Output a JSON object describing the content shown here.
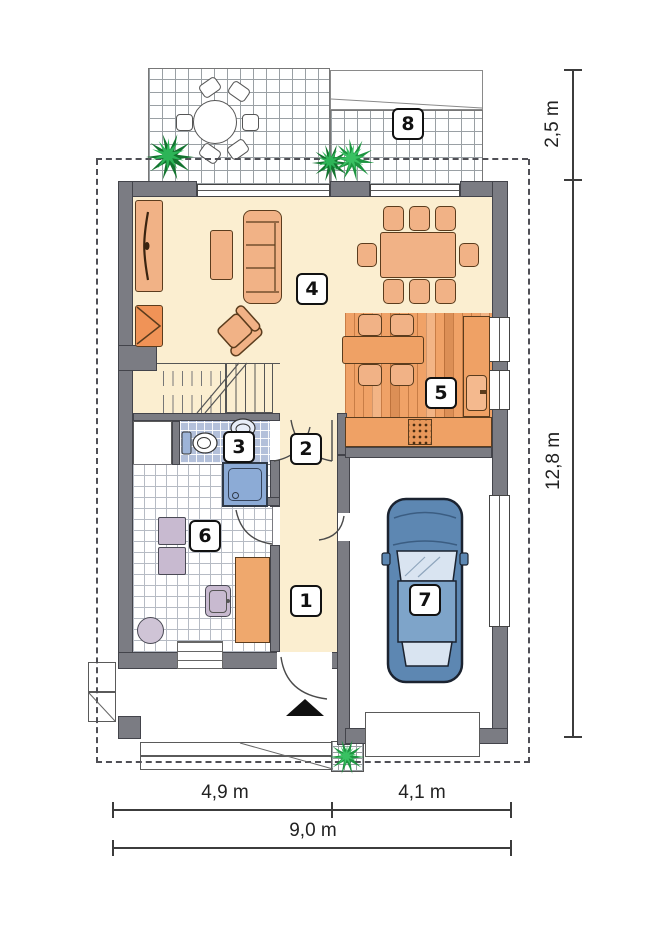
{
  "rooms": [
    {
      "number": "1"
    },
    {
      "number": "2"
    },
    {
      "number": "3"
    },
    {
      "number": "4"
    },
    {
      "number": "5"
    },
    {
      "number": "6"
    },
    {
      "number": "7"
    },
    {
      "number": "8"
    }
  ],
  "dimensions": {
    "right_top": "2,5 m",
    "right_main": "12,8 m",
    "bottom_left": "4,9 m",
    "bottom_right": "4,1 m",
    "bottom_total": "9,0 m"
  },
  "colors": {
    "wall_gray": "#7b7c83",
    "floor_cream": "#fbeed0",
    "wood_floor_orange": "#f0a267",
    "furniture_orange": "#f1b286",
    "fireplace_orange": "#f09357",
    "bathroom_tile_blue": "#b3c0da",
    "shower_blue": "#8cabd6",
    "appliance_mauve": "#c8bad0",
    "car_blue": "#5d87b2",
    "plant_green": "#1d9440",
    "dimension_text": "#222222"
  }
}
